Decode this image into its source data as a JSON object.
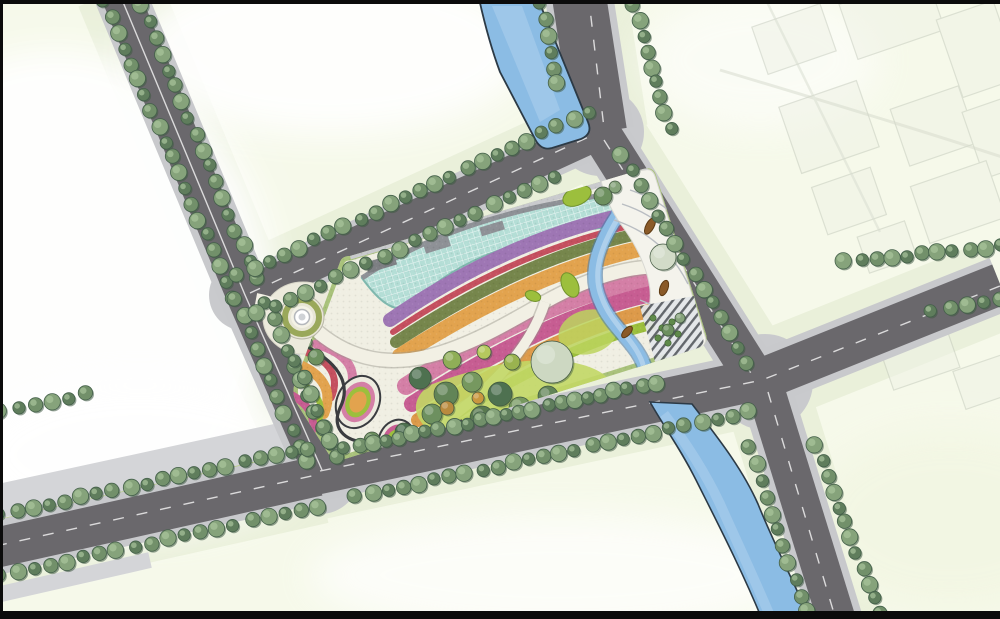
{
  "meta": {
    "kind": "architectural-landscape-masterplan",
    "description": "Aerial colored site plan of a park parcel with swirling terraced planting bands, a teal gridded canopy roof, ponds and streams, surrounded by tree-lined roads, water channels and pale city blocks; ghosted existing buildings upper right; black letterbox bars on frame edges."
  },
  "palette": {
    "frame": "#0b0b0b",
    "bg": "#f6f9ea",
    "corridor_tint": "#e8efd8",
    "white_patch": "#ffffff",
    "road": "#6a686c",
    "sidewalk": "#c8c9cc",
    "apron": "#c9cacd",
    "lane_line": "#efefef",
    "boulevard_strip": "#d4d5d8",
    "boulevard_green": "#b5cc7f",
    "water": "#8bbce4",
    "water_light": "#b7d4ee",
    "water_edge": "#2c3a46",
    "park_base": "#f0efe3",
    "park_rim": "#a9c27b",
    "roof_teal": "#b4ded6",
    "roof_edge": "#7fb8ae",
    "facade_gray": "#8e9196",
    "band_purple": "#9e76b4",
    "band_red": "#c5505f",
    "band_greentex": "#76864c",
    "band_orange": "#e2a34e",
    "band_orange2": "#dd9a4a",
    "band_pink": "#d47fa6",
    "band_magenta": "#c75d92",
    "band_green": "#9cbf3d",
    "path_white": "#f2f0e4",
    "path_dark": "#3a3c40",
    "lawn": "#c2d765",
    "leaf_green": "#9cbf3d",
    "leaf_edge": "#71922c",
    "plaza_white": "#f4f3ec",
    "contour_gray": "#b9bdc2",
    "planter_brown": "#8a5a28",
    "deck_base": "#e3e6e9",
    "deck_stripe": "#565b61",
    "shrub_green": "#5f8a4a",
    "tree_colors": [
      "#5f7d5c",
      "#72906a",
      "#86a37b"
    ],
    "tree_shadow": "#3f5a44",
    "ghost_line": "#c2c8ba",
    "ghost_fill": "#eff2e6"
  },
  "tree_rows": [
    {
      "name": "trees-road-west-upper-left",
      "x1": 104,
      "y1": 2,
      "x2": 233,
      "y2": 297,
      "gap": 17
    },
    {
      "name": "trees-road-west-lower-left",
      "x1": 236,
      "y1": 300,
      "x2": 306,
      "y2": 462,
      "gap": 17
    },
    {
      "name": "trees-road-west-upper-right",
      "x1": 142,
      "y1": 6,
      "x2": 256,
      "y2": 278,
      "gap": 17
    },
    {
      "name": "trees-road-west-lower-right",
      "x1": 266,
      "y1": 304,
      "x2": 336,
      "y2": 458,
      "gap": 17
    },
    {
      "name": "trees-park-north-road-north",
      "x1": 238,
      "y1": 276,
      "x2": 588,
      "y2": 112,
      "gap": 17
    },
    {
      "name": "trees-park-north-road-south",
      "x1": 258,
      "y1": 314,
      "x2": 555,
      "y2": 176,
      "gap": 17
    },
    {
      "name": "trees-north-spur-west",
      "x1": 541,
      "y1": 4,
      "x2": 557,
      "y2": 84,
      "gap": 16
    },
    {
      "name": "trees-north-spur-east",
      "x1": 634,
      "y1": 6,
      "x2": 670,
      "y2": 128,
      "gap": 16
    },
    {
      "name": "trees-park-east-road",
      "x1": 622,
      "y1": 156,
      "x2": 748,
      "y2": 362,
      "gap": 17
    },
    {
      "name": "trees-park-south-edge",
      "x1": 345,
      "y1": 449,
      "x2": 655,
      "y2": 383,
      "gap": 14
    },
    {
      "name": "trees-main-road-south",
      "x1": 356,
      "y1": 497,
      "x2": 748,
      "y2": 412,
      "gap": 16
    },
    {
      "name": "trees-main-road-northeast",
      "x1": 845,
      "y1": 262,
      "x2": 1000,
      "y2": 246,
      "gap": 16
    },
    {
      "name": "trees-main-road-southeast",
      "x1": 932,
      "y1": 312,
      "x2": 1000,
      "y2": 298,
      "gap": 16
    },
    {
      "name": "trees-southeast-road-west",
      "x1": 750,
      "y1": 448,
      "x2": 806,
      "y2": 612,
      "gap": 17
    },
    {
      "name": "trees-southeast-road-east",
      "x1": 816,
      "y1": 446,
      "x2": 880,
      "y2": 614,
      "gap": 17
    },
    {
      "name": "trees-boulevard-north",
      "x1": 0,
      "y1": 515,
      "x2": 308,
      "y2": 448,
      "gap": 17
    },
    {
      "name": "trees-boulevard-south",
      "x1": 0,
      "y1": 576,
      "x2": 318,
      "y2": 506,
      "gap": 17
    },
    {
      "name": "trees-block-corner",
      "x1": 0,
      "y1": 412,
      "x2": 86,
      "y2": 394,
      "gap": 17
    },
    {
      "name": "trees-park-west-edge",
      "x1": 296,
      "y1": 362,
      "x2": 330,
      "y2": 442,
      "gap": 16
    }
  ],
  "park_trees": [
    {
      "x": 420,
      "y": 378,
      "r": 11,
      "c": "#4e7150"
    },
    {
      "x": 446,
      "y": 394,
      "r": 12,
      "c": "#628457"
    },
    {
      "x": 472,
      "y": 382,
      "r": 10,
      "c": "#76985f"
    },
    {
      "x": 500,
      "y": 394,
      "r": 12,
      "c": "#4e7150"
    },
    {
      "x": 432,
      "y": 414,
      "r": 10,
      "c": "#6d905f"
    },
    {
      "x": 482,
      "y": 418,
      "r": 12,
      "c": "#59794f"
    },
    {
      "x": 520,
      "y": 408,
      "r": 11,
      "c": "#76985f"
    },
    {
      "x": 548,
      "y": 396,
      "r": 10,
      "c": "#628457"
    },
    {
      "x": 404,
      "y": 432,
      "r": 9,
      "c": "#4e7150"
    },
    {
      "x": 372,
      "y": 440,
      "r": 8,
      "c": "#6d905f"
    },
    {
      "x": 562,
      "y": 424,
      "r": 10,
      "c": "#59794f"
    },
    {
      "x": 592,
      "y": 408,
      "r": 9,
      "c": "#76985f"
    },
    {
      "x": 614,
      "y": 390,
      "r": 8,
      "c": "#628457"
    },
    {
      "x": 452,
      "y": 360,
      "r": 9,
      "c": "#8fae57"
    },
    {
      "x": 512,
      "y": 362,
      "r": 8,
      "c": "#9ab34f"
    },
    {
      "x": 484,
      "y": 352,
      "r": 7,
      "c": "#b5c95e"
    },
    {
      "x": 438,
      "y": 442,
      "r": 8,
      "c": "#4e7150"
    },
    {
      "x": 510,
      "y": 438,
      "r": 9,
      "c": "#628457"
    },
    {
      "x": 580,
      "y": 438,
      "r": 8,
      "c": "#6d905f"
    },
    {
      "x": 447,
      "y": 408,
      "r": 7,
      "c": "#b98a3e"
    },
    {
      "x": 478,
      "y": 398,
      "r": 6,
      "c": "#c9973f"
    },
    {
      "x": 552,
      "y": 362,
      "r": 21,
      "c": "#cdd8c2"
    },
    {
      "x": 663,
      "y": 257,
      "r": 13,
      "c": "#d2dbc8"
    },
    {
      "x": 603,
      "y": 196,
      "r": 9,
      "c": "#6d905f"
    },
    {
      "x": 615,
      "y": 187,
      "r": 6,
      "c": "#86a37b"
    },
    {
      "x": 316,
      "y": 357,
      "r": 8,
      "c": "#6d905f"
    },
    {
      "x": 306,
      "y": 342,
      "r": 6,
      "c": "#86a37b"
    },
    {
      "x": 668,
      "y": 330,
      "r": 6,
      "c": "#6d905f"
    },
    {
      "x": 680,
      "y": 318,
      "r": 5,
      "c": "#86a37b"
    }
  ],
  "deck_shrubs": [
    {
      "x": 653,
      "y": 318
    },
    {
      "x": 662,
      "y": 328
    },
    {
      "x": 672,
      "y": 322
    },
    {
      "x": 658,
      "y": 338
    },
    {
      "x": 668,
      "y": 343
    },
    {
      "x": 678,
      "y": 334
    }
  ],
  "planters": [
    {
      "x": 650,
      "y": 226,
      "rx": 9,
      "ry": 4,
      "rot": -62
    },
    {
      "x": 664,
      "y": 288,
      "rx": 8,
      "ry": 4,
      "rot": -70
    },
    {
      "x": 627,
      "y": 332,
      "rx": 7,
      "ry": 3.5,
      "rot": -48
    }
  ],
  "ghost_buildings": [
    {
      "x": 758,
      "y": 14,
      "w": 72,
      "h": 50
    },
    {
      "x": 846,
      "y": -12,
      "w": 92,
      "h": 58
    },
    {
      "x": 948,
      "y": 8,
      "w": 60,
      "h": 82
    },
    {
      "x": 788,
      "y": 92,
      "w": 82,
      "h": 70
    },
    {
      "x": 898,
      "y": 96,
      "w": 72,
      "h": 60
    },
    {
      "x": 972,
      "y": 102,
      "w": 52,
      "h": 70
    },
    {
      "x": 818,
      "y": 176,
      "w": 62,
      "h": 50
    },
    {
      "x": 918,
      "y": 172,
      "w": 80,
      "h": 60
    },
    {
      "x": 862,
      "y": 228,
      "w": 50,
      "h": 38
    },
    {
      "x": 884,
      "y": 332,
      "w": 70,
      "h": 48
    },
    {
      "x": 958,
      "y": 362,
      "w": 52,
      "h": 40
    }
  ]
}
